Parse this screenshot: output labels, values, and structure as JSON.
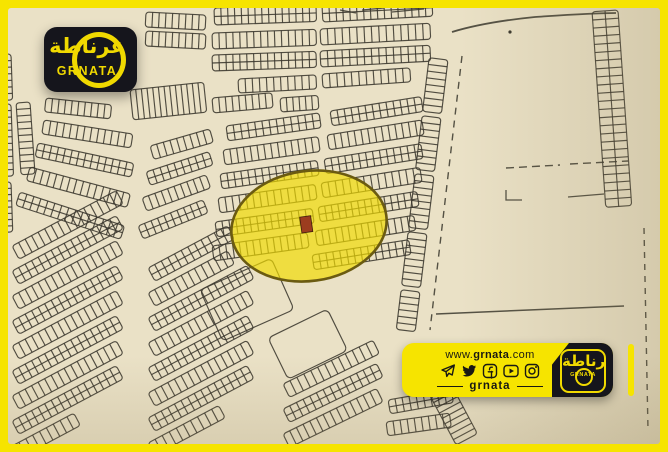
{
  "colors": {
    "frame_yellow": "#f6e400",
    "map_background": "#eae1c6",
    "map_ink": "#3a372d",
    "map_shade": "#8a7a52",
    "highlight_fill": "#f2dc00",
    "highlight_stroke": "#6b5b11",
    "highlighted_plot_red": "#9c3d1f",
    "panel_black": "#15151c",
    "brand_yellow": "#f0d900"
  },
  "logo": {
    "arabic": "غرناطة",
    "latin": "GRNATA"
  },
  "map": {
    "highlight": {
      "shape": "ellipse",
      "note": "highlighted-area"
    }
  },
  "banner": {
    "website": {
      "prefix": "www.",
      "name": "grnata",
      "suffix": ".com"
    },
    "social_icons": [
      "telegram-icon",
      "twitter-icon",
      "facebook-icon",
      "youtube-icon",
      "instagram-icon"
    ],
    "handle": "grnata",
    "logo": {
      "arabic": "غرناطة",
      "latin": "GRNATA"
    }
  }
}
